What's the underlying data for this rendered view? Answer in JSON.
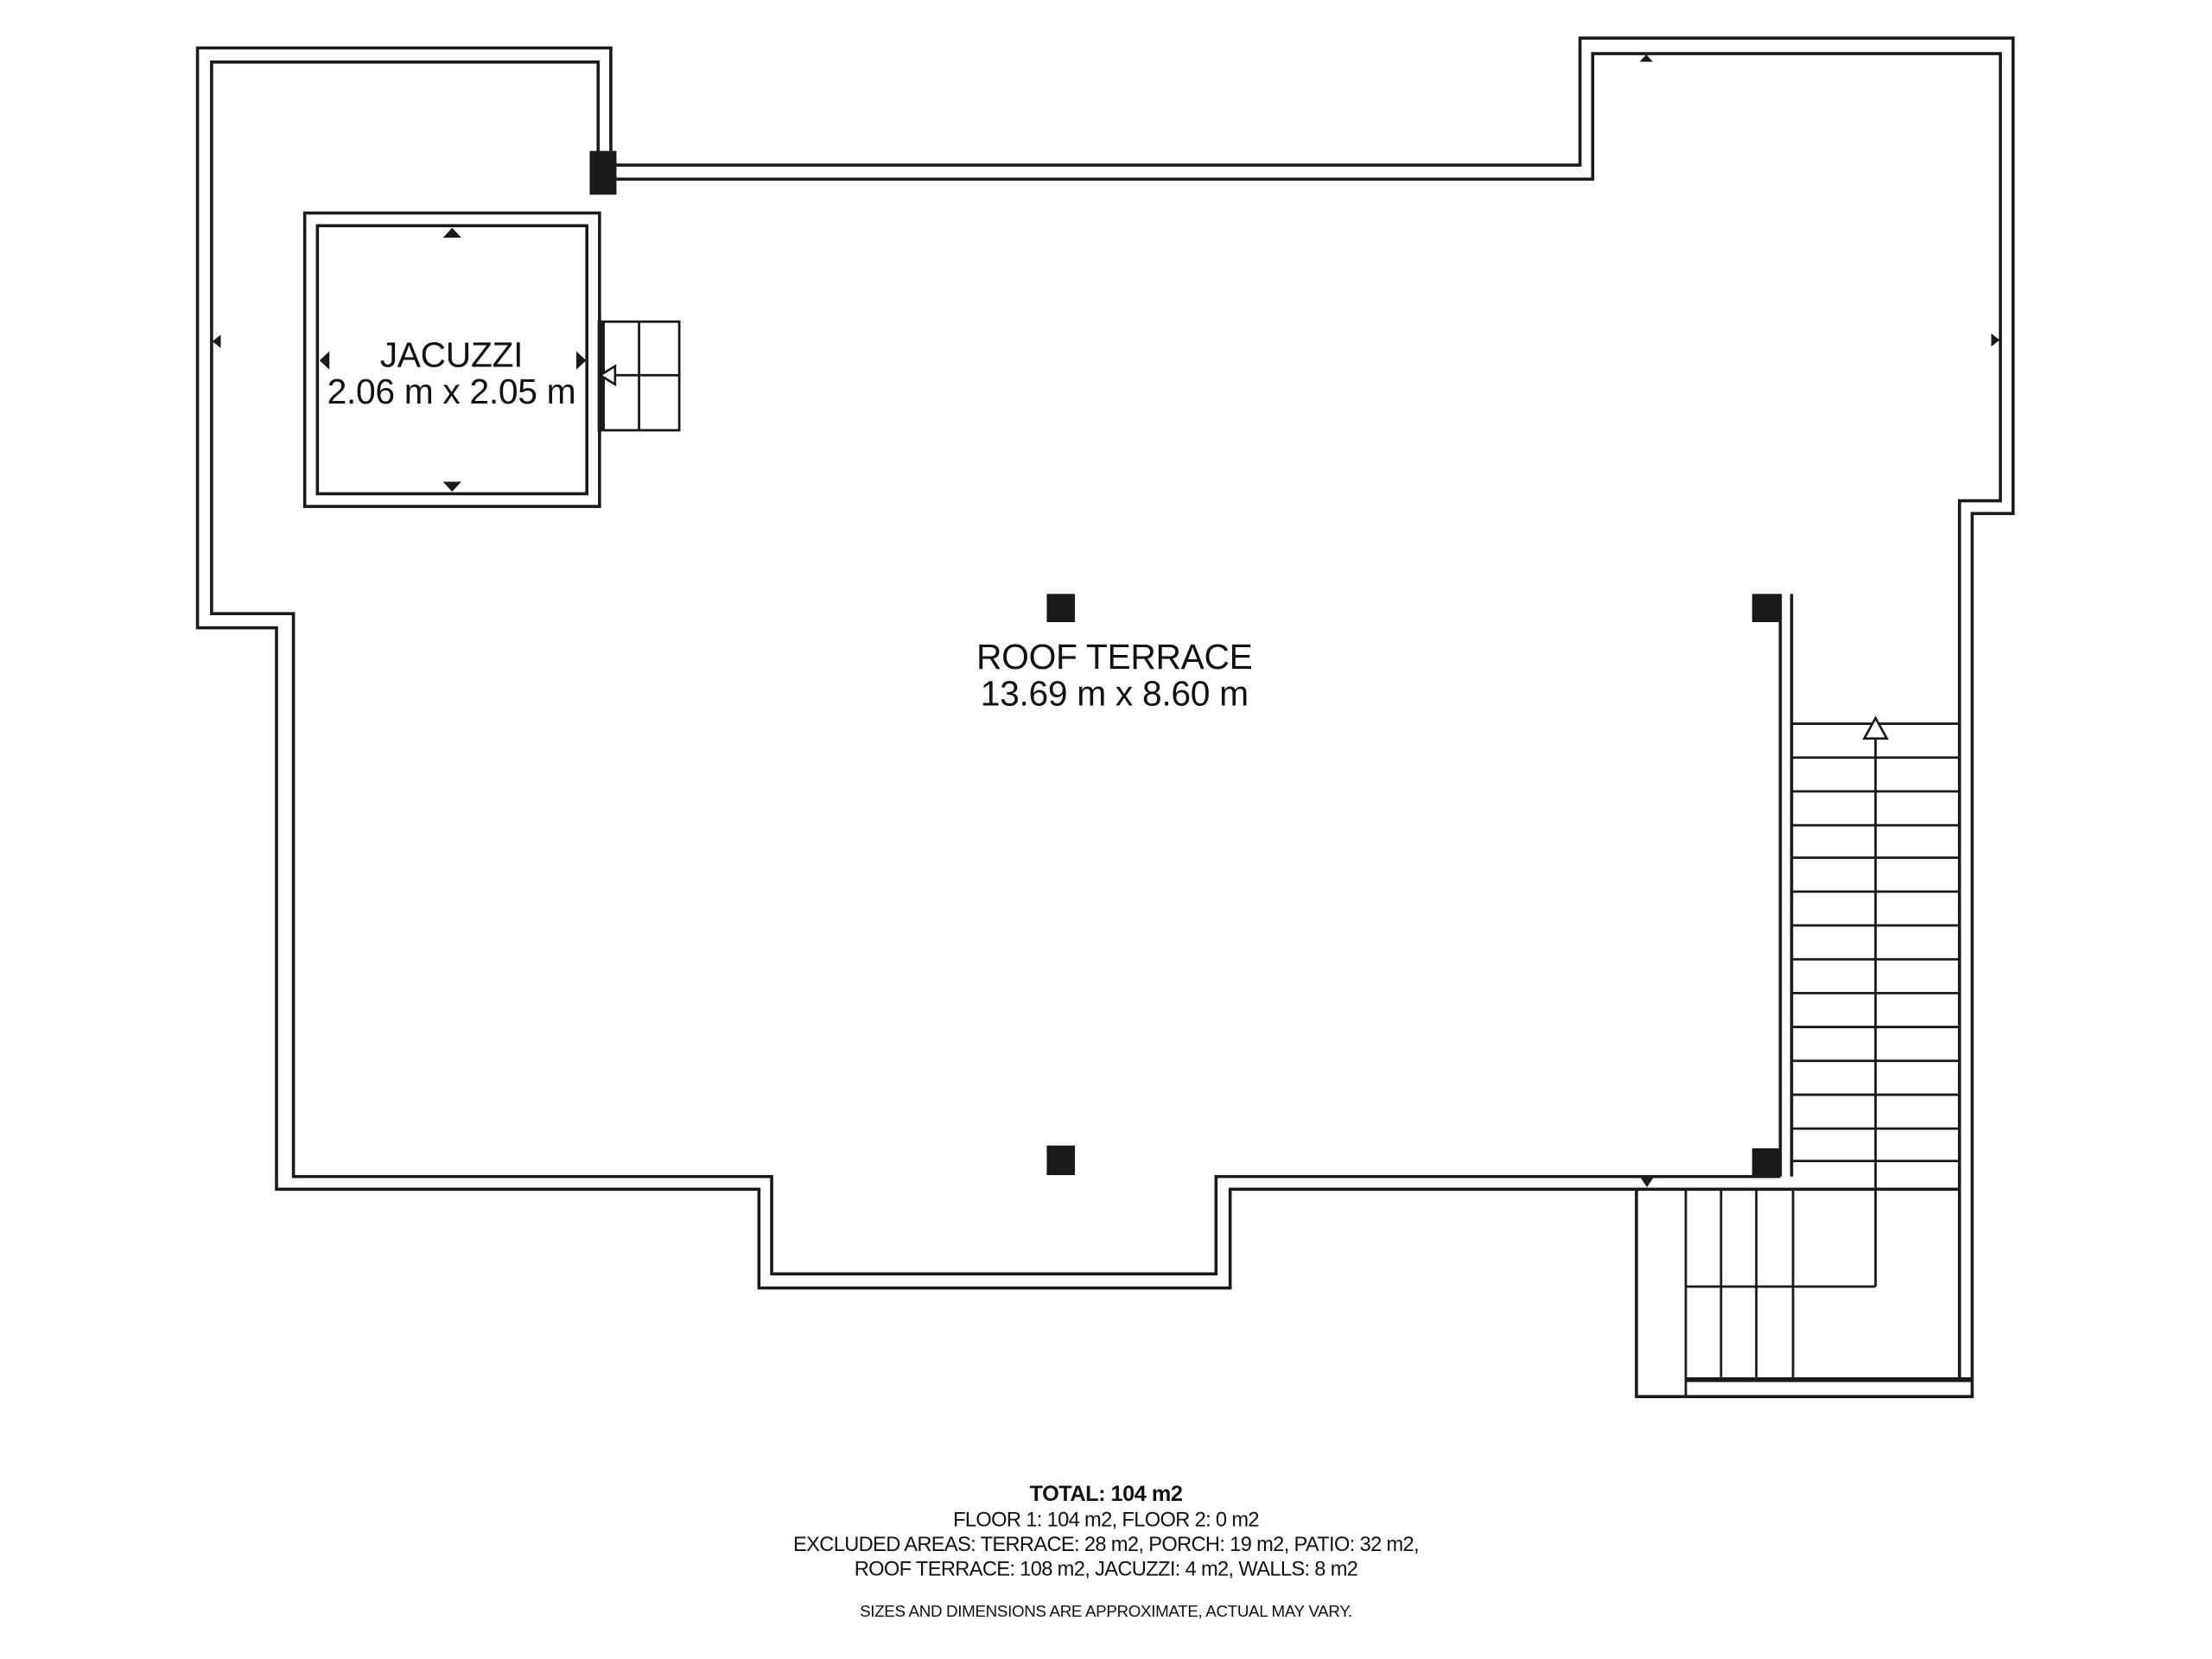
{
  "floor_plan": {
    "rooms": [
      {
        "name": "JACUZZI",
        "dimensions": "2.06 m x 2.05 m"
      },
      {
        "name": "ROOF TERRACE",
        "dimensions": "13.69 m x 8.60 m"
      }
    ],
    "summary": {
      "total": "TOTAL: 104 m2",
      "floors": "FLOOR 1: 104 m2, FLOOR 2: 0 m2",
      "excluded_line1": "EXCLUDED AREAS: TERRACE: 28 m2, PORCH: 19 m2, PATIO: 32 m2,",
      "excluded_line2": "ROOF TERRACE: 108 m2, JACUZZI: 4 m2, WALLS: 8 m2",
      "disclaimer": "SIZES AND DIMENSIONS ARE APPROXIMATE, ACTUAL MAY VARY."
    },
    "colors": {
      "wall": "#1a1a1a",
      "background": "#ffffff"
    }
  }
}
